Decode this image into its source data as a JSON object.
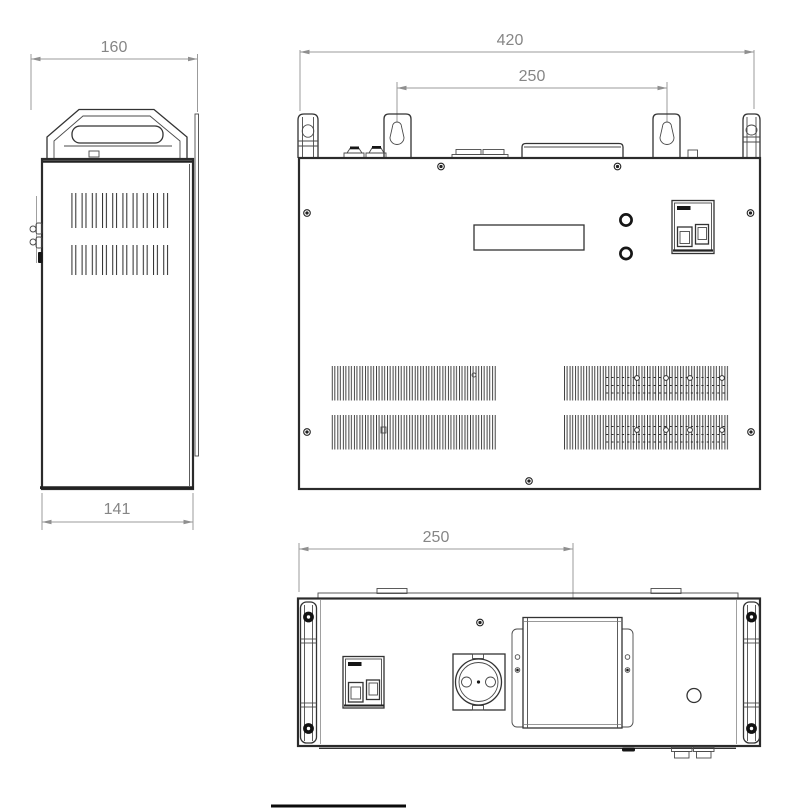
{
  "drawing": {
    "kind": "technical-drawing-three-views",
    "dimensions": {
      "side_width": "160",
      "side_depth": "141",
      "front_width": "420",
      "front_mount_spacing": "250",
      "bottom_mount_offset": "250"
    },
    "colors": {
      "outline": "#2b2b2b",
      "detail": "#333333",
      "dimension_line": "#9b9b9b",
      "dimension_text": "#868686",
      "dark_fill": "#161616",
      "background": "#ffffff"
    }
  }
}
